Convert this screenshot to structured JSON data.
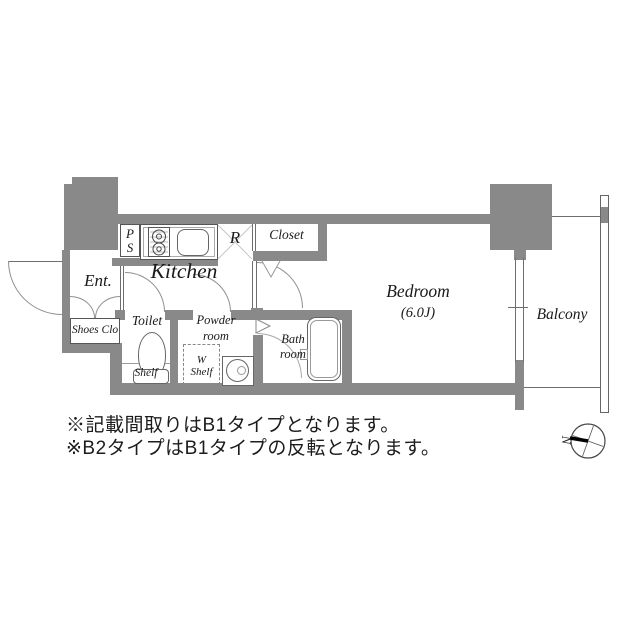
{
  "plan": {
    "rooms": {
      "entrance_label": "Ent.",
      "shoes_closet_label": "Shoes Clo",
      "pipe_space_line1": "P",
      "pipe_space_line2": "S",
      "kitchen_label": "Kitchen",
      "refrigerator_label": "R",
      "closet_label": "Closet",
      "toilet_label": "Toilet",
      "toilet_shelf_label": "Shelf",
      "powder_room_line1": "Powder",
      "powder_room_line2": "room",
      "w_shelf_line1": "W",
      "w_shelf_line2": "Shelf",
      "bath_room_line1": "Bath",
      "bath_room_line2": "room",
      "bedroom_label": "Bedroom",
      "bedroom_size": "(6.0J)",
      "balcony_label": "Balcony"
    },
    "compass": {
      "north_label": "N"
    }
  },
  "notes": {
    "line1": "※記載間取りはB1タイプとなります。",
    "line2": "※B2タイプはB1タイプの反転となります。"
  },
  "colors": {
    "wall": "#898989",
    "line": "#6e6e6e",
    "light_line": "#9c9c9c",
    "text": "#1a1a1a"
  }
}
